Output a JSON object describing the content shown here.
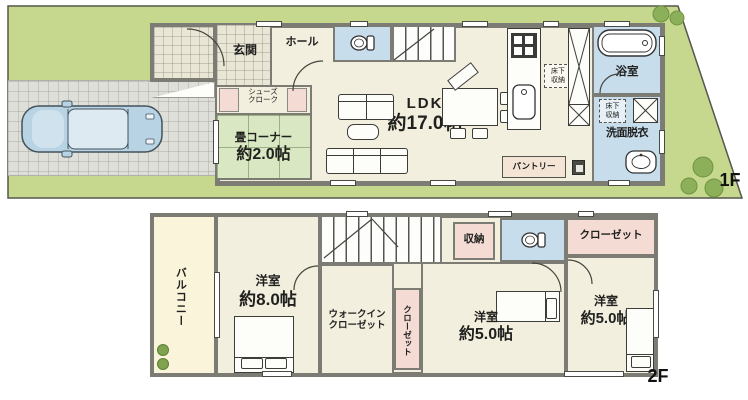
{
  "f1": {
    "floor_label": "1F",
    "genkan": "玄関",
    "hall": "ホール",
    "shoes_cloak": [
      "シューズ",
      "クローク"
    ],
    "tatami_corner": [
      "畳コーナー",
      "約2.0帖"
    ],
    "ldk": [
      "LDK",
      "約17.0帖"
    ],
    "underfloor_storage_kitchen": [
      "床下",
      "収納"
    ],
    "underfloor_storage_washroom": [
      "床下",
      "収納"
    ],
    "pantry": "パントリー",
    "bathroom": "浴室",
    "washroom": "洗面脱衣"
  },
  "f2": {
    "floor_label": "2F",
    "balcony": "バルコニー",
    "bedroom_8": [
      "洋室",
      "約8.0帖"
    ],
    "walk_in_closet": [
      "ウォークイン",
      "クローゼット"
    ],
    "closet_side": "クローゼット",
    "storage": "収納",
    "bedroom_5_center": [
      "洋室",
      "約5.0帖"
    ],
    "closet_top": "クローゼット",
    "bedroom_5_right": [
      "洋室",
      "約5.0帖"
    ]
  },
  "colors": {
    "site_green": "#c6d88e",
    "driveway_gray": "#dedfd8",
    "wall_gray": "#7c7c74",
    "room_cream": "#f3efde",
    "wet_area_blue": "#c7ddec",
    "tatami_green": "#d9e7c2",
    "closet_pink": "#f4dbd3",
    "balcony_cream": "#f9f4da",
    "car_blue": "#b7d3e4",
    "bush_green": "#8caf5a"
  }
}
